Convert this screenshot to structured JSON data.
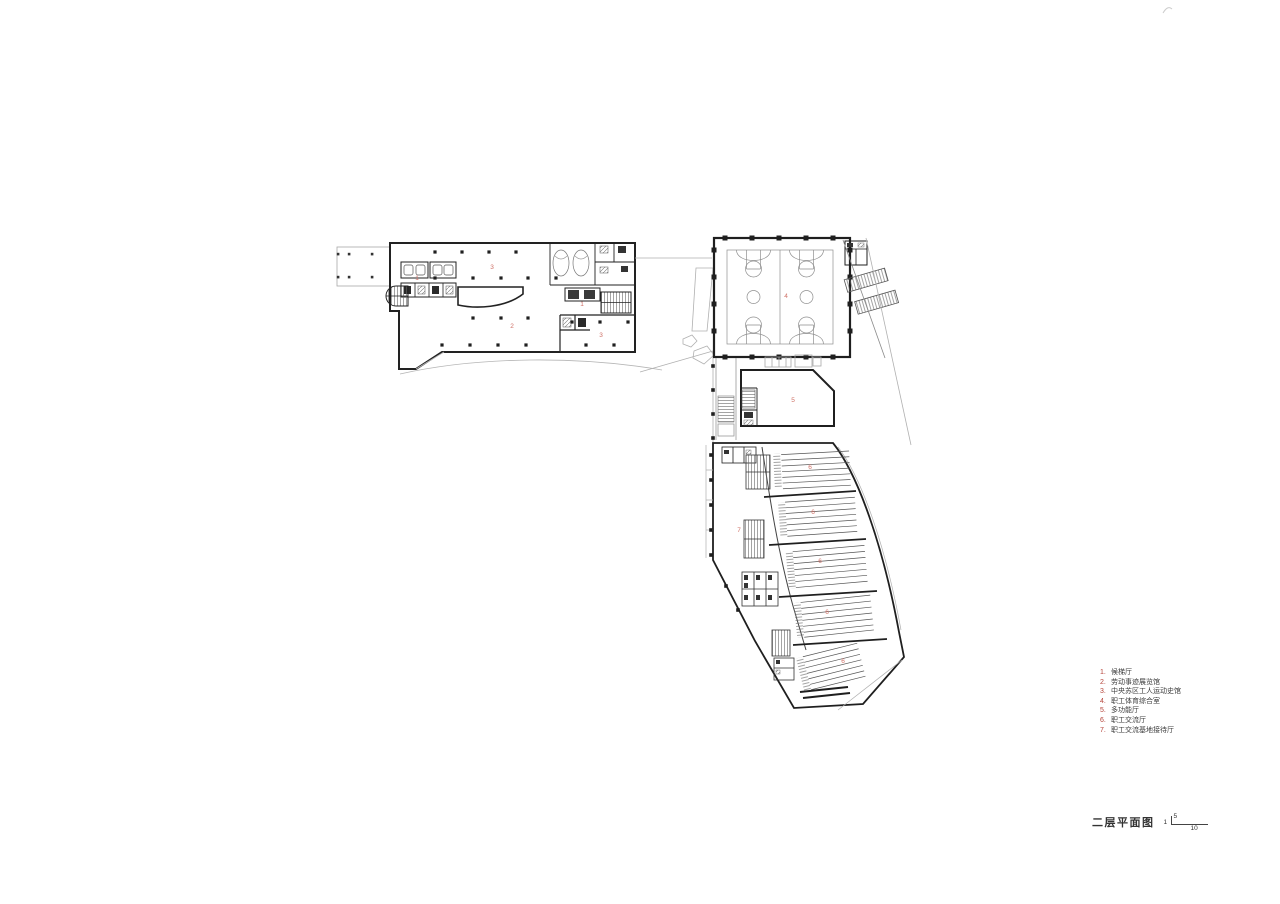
{
  "colors": {
    "accent_red": "#b5443a",
    "room_label_red": "#cf7066",
    "wall": "#222222",
    "light_line": "#b0b0b0"
  },
  "legend": {
    "items": [
      {
        "num": "1.",
        "label": "候梯厅"
      },
      {
        "num": "2.",
        "label": "劳动事迹展览馆"
      },
      {
        "num": "3.",
        "label": "中央苏区工人运动史馆"
      },
      {
        "num": "4.",
        "label": "职工体育综合室"
      },
      {
        "num": "5.",
        "label": "多功能厅"
      },
      {
        "num": "6.",
        "label": "职工交流厅"
      },
      {
        "num": "7.",
        "label": "职工交流基地接待厅"
      }
    ]
  },
  "title_block": {
    "title": "二层平面图",
    "scale_start": "1",
    "scale_upper": "5",
    "scale_lower": "10"
  },
  "plan_labels": [
    {
      "text": "1",
      "x": 417,
      "y": 279
    },
    {
      "text": "3",
      "x": 492,
      "y": 268
    },
    {
      "text": "2",
      "x": 512,
      "y": 327
    },
    {
      "text": "1",
      "x": 582,
      "y": 305
    },
    {
      "text": "3",
      "x": 601,
      "y": 336
    },
    {
      "text": "4",
      "x": 786,
      "y": 297
    },
    {
      "text": "5",
      "x": 793,
      "y": 401
    },
    {
      "text": "7",
      "x": 739,
      "y": 531
    },
    {
      "text": "6",
      "x": 810,
      "y": 468
    },
    {
      "text": "6",
      "x": 813,
      "y": 513
    },
    {
      "text": "6",
      "x": 820,
      "y": 562
    },
    {
      "text": "6",
      "x": 827,
      "y": 613
    },
    {
      "text": "6",
      "x": 843,
      "y": 662
    }
  ]
}
